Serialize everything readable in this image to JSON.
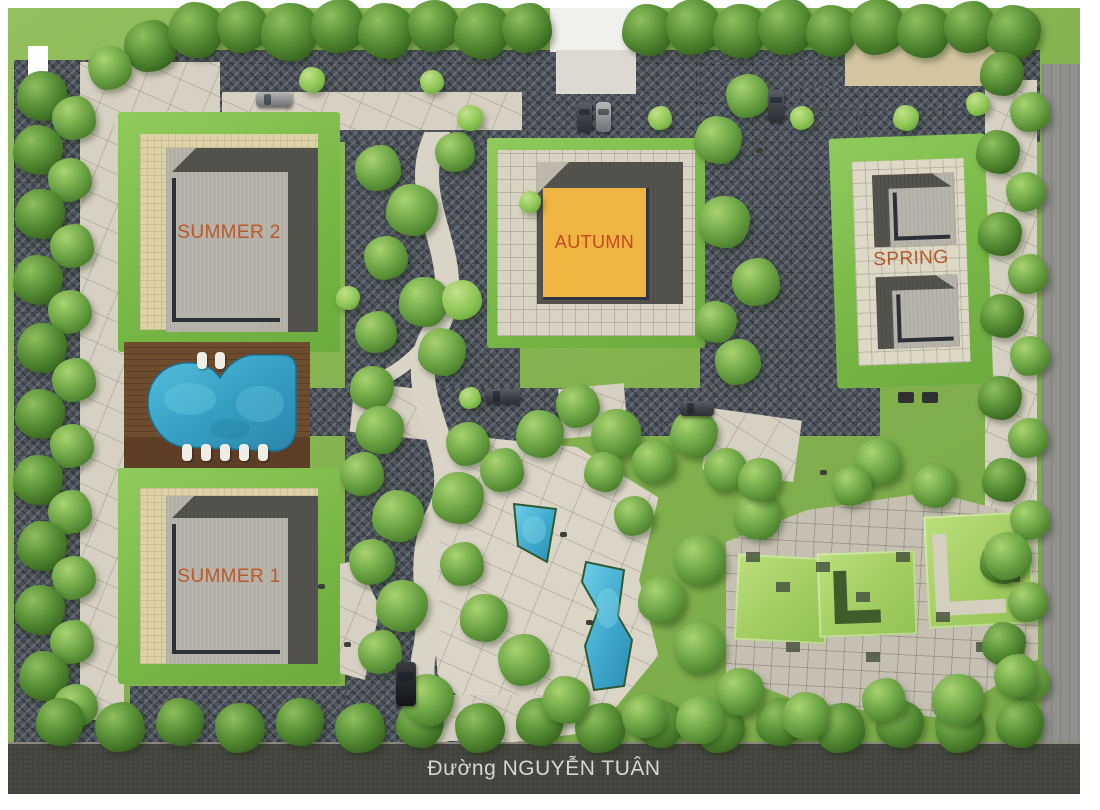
{
  "buildings": {
    "summer2": {
      "label": "SUMMER 2",
      "label_color": "#bd5827"
    },
    "summer1": {
      "label": "SUMMER 1",
      "label_color": "#bd5827"
    },
    "autumn": {
      "label": "AUTUMN",
      "label_color": "#c04a22",
      "roof_center_color": "#efb441"
    },
    "spring": {
      "label": "SPRING",
      "label_color": "#b05b2b"
    }
  },
  "street": {
    "label": "Đường NGUYỄN TUÂN",
    "text_color": "#d6d6d2",
    "road_color": "#43433d"
  },
  "amenities": {
    "pool_color": "#3aa9cd",
    "deck_color": "#6f4c2e",
    "pond_color": "#45b2d4"
  },
  "palette": {
    "grass": "#83b14e",
    "tree_dark": "#38671f",
    "tree_light": "#8cc455",
    "paving": "#d7d1c3",
    "permeable_paving": "#4e555e",
    "roof_gray": "#b7b4ab",
    "roof_shadow": "#55534d",
    "beige_paving": "#ddd1a6"
  }
}
